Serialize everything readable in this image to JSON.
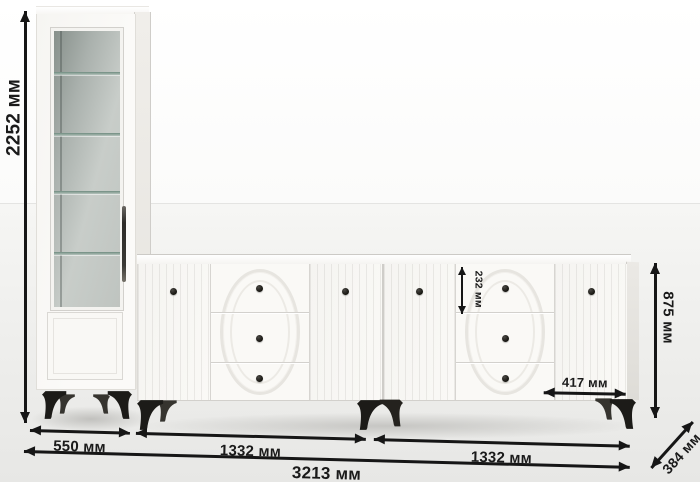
{
  "dimensions": {
    "cabinet_height": "2252 мм",
    "cabinet_width": "550 мм",
    "sideboard_left_width": "1332 мм",
    "sideboard_right_width": "1332 мм",
    "total_width": "3213 мм",
    "sideboard_height": "875 мм",
    "top_drawer_height": "232 мм",
    "right_door_width": "417 мм",
    "depth": "384 мм"
  },
  "colors": {
    "annotation": "#161616",
    "furniture_white": "#f8f7f4",
    "legs_and_knobs": "#1c1b19",
    "glass": "#b4bcb7"
  }
}
